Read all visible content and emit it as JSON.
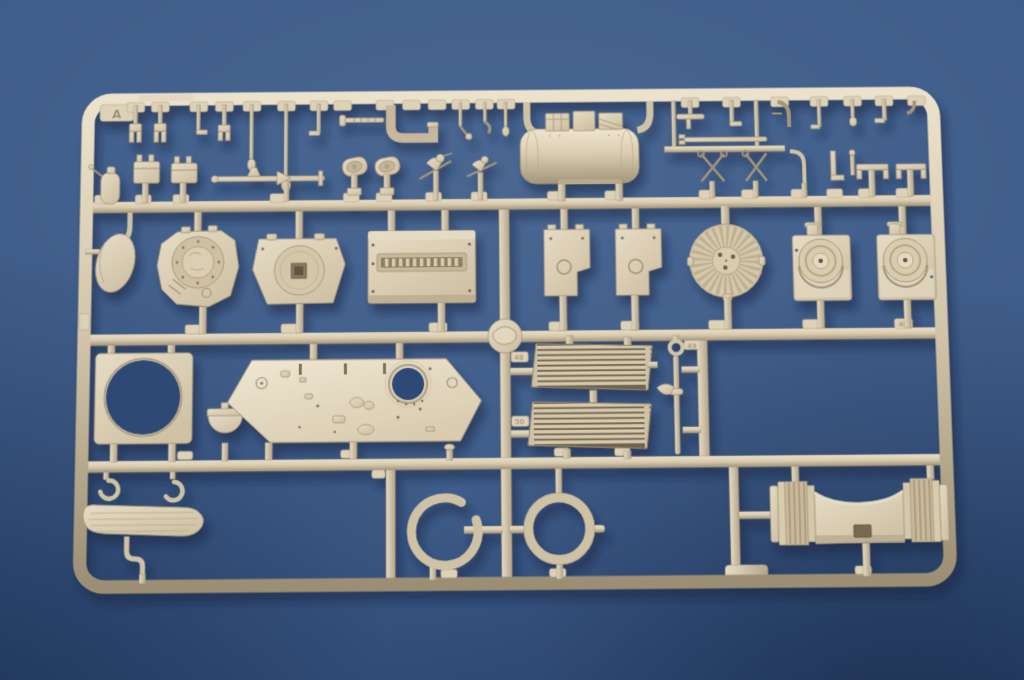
{
  "scene": {
    "description": "Photograph of an injection-molded plastic model kit sprue (parts runner) in tan/beige styrene, lying on a blue backdrop",
    "subject": "model-kit-sprue",
    "background_color": "#3e5c8a",
    "plastic_color": "#d7c9ad",
    "plastic_highlight": "#ece2cc",
    "plastic_shadow": "#a3947a"
  },
  "sprue": {
    "letter": "A",
    "visible_part_numbers": [
      "48",
      "49",
      "50",
      "40"
    ],
    "rows": 5,
    "parts": [
      {
        "id": "small-clevis-forks",
        "zone": "top-rail",
        "desc": "row of tiny forked clamps and hooks hanging from the top rail"
      },
      {
        "id": "j-shaped-pipe",
        "zone": "top-rail",
        "desc": "thick J-shaped tube with screw rod"
      },
      {
        "id": "muffler-cylinder",
        "zone": "row-2",
        "desc": "large horizontal cylinder with three box fittings on top and curved feed arms"
      },
      {
        "id": "canteen-bottle",
        "zone": "row-2",
        "desc": "small bottle with wire hook"
      },
      {
        "id": "stowage-boxes",
        "zone": "row-2",
        "desc": "two small lidded boxes"
      },
      {
        "id": "axle-rod",
        "zone": "row-2",
        "desc": "long thin axle with cone and knob fittings"
      },
      {
        "id": "periscopes",
        "zone": "row-2",
        "desc": "two oval periscope heads on stems"
      },
      {
        "id": "lever-linkages",
        "zone": "row-2",
        "desc": "crossed lever / plier-like linkages and bent pipes"
      },
      {
        "id": "oval-shield",
        "zone": "row-3",
        "desc": "small oval shield plate attached to left rail"
      },
      {
        "id": "turret-ring-casting",
        "zone": "row-3",
        "desc": "rounded casting with circular hatch ring and bolt detail"
      },
      {
        "id": "trapezoid-disc-plate",
        "zone": "row-3",
        "desc": "trapezoidal plate with raised disc and square opening"
      },
      {
        "id": "vented-box-plate",
        "zone": "row-3",
        "desc": "large box plate with toothed vent slot"
      },
      {
        "id": "notched-plate-left",
        "zone": "row-3",
        "desc": "rectangular plate with side notch and round boss"
      },
      {
        "id": "notched-plate-right",
        "zone": "row-3",
        "desc": "rectangular plate with side notch and round boss"
      },
      {
        "id": "radial-fan-disc",
        "zone": "row-3",
        "desc": "circular disc with radial cooling fins and three holes"
      },
      {
        "id": "final-drive-housing-left",
        "zone": "row-3",
        "desc": "box housing with round hub and volute"
      },
      {
        "id": "final-drive-housing-right",
        "zone": "row-3",
        "desc": "box housing with round hub and volute"
      },
      {
        "id": "gate-hub",
        "zone": "row-3-rail",
        "desc": "round injection-gate boss with swirl mark on center rail"
      },
      {
        "id": "square-plate-round-hole",
        "zone": "row-4",
        "desc": "square plate pierced by a large circular hole"
      },
      {
        "id": "half-cup",
        "zone": "row-4",
        "desc": "small semicircular cup"
      },
      {
        "id": "hull-deck-plate",
        "zone": "row-4",
        "desc": "wide hexagonal deck plate with circular opening and many small fittings"
      },
      {
        "id": "engine-grille-upper",
        "zone": "row-4",
        "desc": "louvered engine grille with eight slats"
      },
      {
        "id": "engine-grille-lower",
        "zone": "row-4",
        "desc": "louvered engine grille with eight slats"
      },
      {
        "id": "eyelet-rod",
        "zone": "row-4",
        "desc": "long thin rod with eyelet head and collar"
      },
      {
        "id": "hook-loops",
        "zone": "row-5",
        "desc": "two small open hook loops"
      },
      {
        "id": "wood-plank",
        "zone": "row-5",
        "desc": "elongated rounded plank with grain lines"
      },
      {
        "id": "s-bracket",
        "zone": "row-5",
        "desc": "small S-shaped bracket"
      },
      {
        "id": "split-ring",
        "zone": "row-5",
        "desc": "open C-shaped ring"
      },
      {
        "id": "full-ring",
        "zone": "row-5",
        "desc": "closed circular ring with four gates"
      },
      {
        "id": "gun-cradle-saddle",
        "zone": "row-5",
        "desc": "large saddle-shaped cradle with ribbed cylindrical trunnion ends"
      }
    ]
  }
}
